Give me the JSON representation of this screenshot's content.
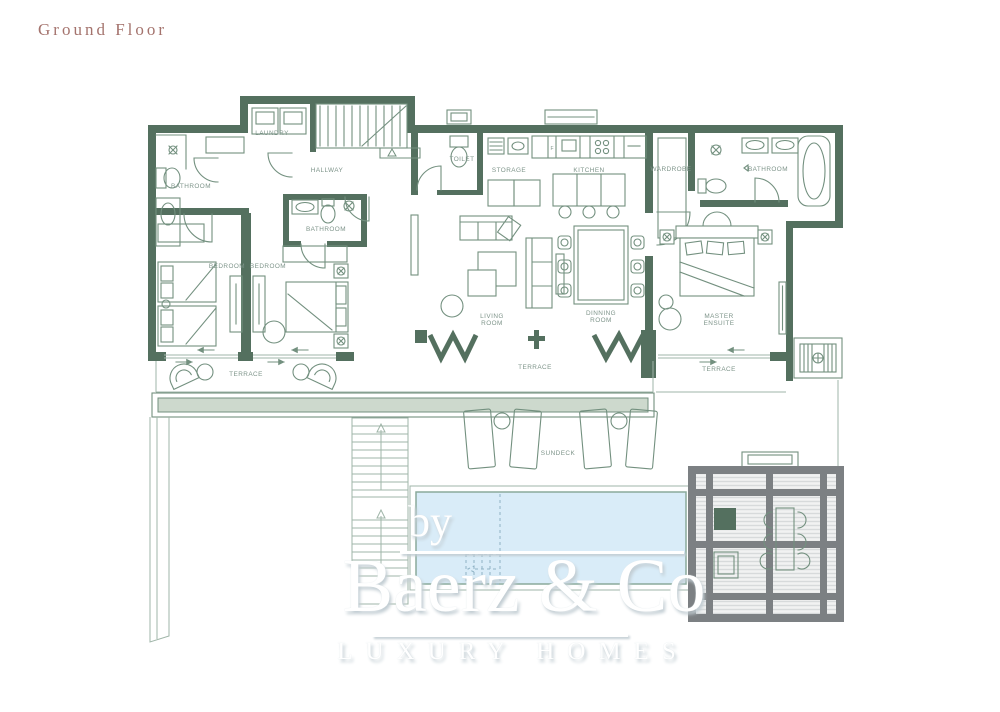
{
  "title": "Ground Floor",
  "colors": {
    "wall": "#54705F",
    "line": "#73907F",
    "lineLight": "#9FB5A8",
    "label": "#7E948A",
    "title": "#A4736D",
    "pool": "#D9ECF8",
    "poolLine": "#8AAA9B",
    "planter": "#CDD9CD",
    "pergolaFrame": "#7C8083",
    "pergolaSlat": "#D7DADB",
    "watermarkShadow": "#C2CDD3"
  },
  "rooms": {
    "bathroom_left": "BATHROOM",
    "laundry": "LAUNDRY",
    "hallway": "HALLWAY",
    "toilet": "TOILET",
    "storage": "STORAGE",
    "kitchen": "KITCHEN",
    "wardrobe": "WARDROBE",
    "bathroom_master": "BATHROOM",
    "bathroom_middle": "BATHROOM",
    "bedroom_left": "BEDROOM",
    "bedroom_right": "BEDROOM",
    "living_line1": "LIVING",
    "living_line2": "ROOM",
    "dining_line1": "DINNING",
    "dining_line2": "ROOM",
    "master_line1": "MASTER",
    "master_line2": "ENSUITE",
    "terrace_left": "TERRACE",
    "terrace_middle": "TERRACE",
    "terrace_right": "TERRACE",
    "sundeck": "SUNDECK",
    "fridge": "F"
  },
  "watermark": {
    "by": "by",
    "name": "Baerz & Co",
    "tagline": "LUXURY HOMES"
  }
}
